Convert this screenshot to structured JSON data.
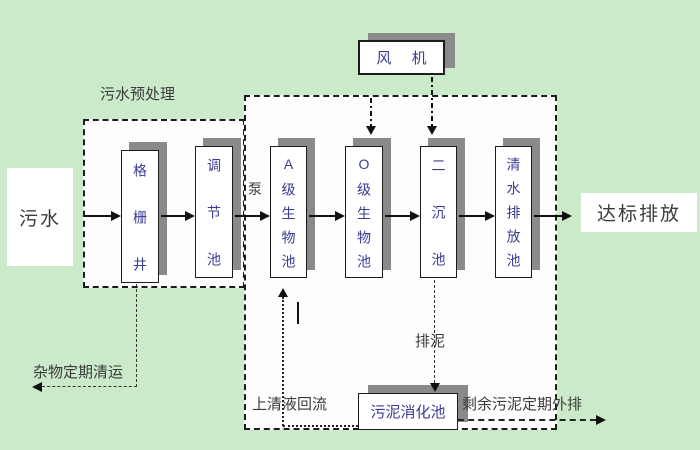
{
  "nodes": {
    "inflow": {
      "label": "污水"
    },
    "grid_well": {
      "label": "格栅井"
    },
    "regulating": {
      "label": "调节池"
    },
    "pump": {
      "label": "泵"
    },
    "a_bio": {
      "label": "A级生物池"
    },
    "o_bio": {
      "label": "O级生物池"
    },
    "secondary": {
      "label": "二沉池"
    },
    "clean_water": {
      "label": "清水排放池"
    },
    "fan": {
      "label": "风 机"
    },
    "digestion": {
      "label": "污泥消化池"
    },
    "outflow": {
      "label": "达标排放"
    }
  },
  "annotations": {
    "pretreatment": "污水预处理",
    "debris_removal": "杂物定期清运",
    "supernatant_reflux": "上清液回流",
    "sludge_discharge": "排泥",
    "excess_sludge": "剩余污泥定期外排"
  },
  "colors": {
    "background": "#caeaca",
    "box-text": "#3b3b96",
    "label-text": "#3a3a3a",
    "shadow": "#8a8a8a",
    "line": "#1c1c1c"
  }
}
